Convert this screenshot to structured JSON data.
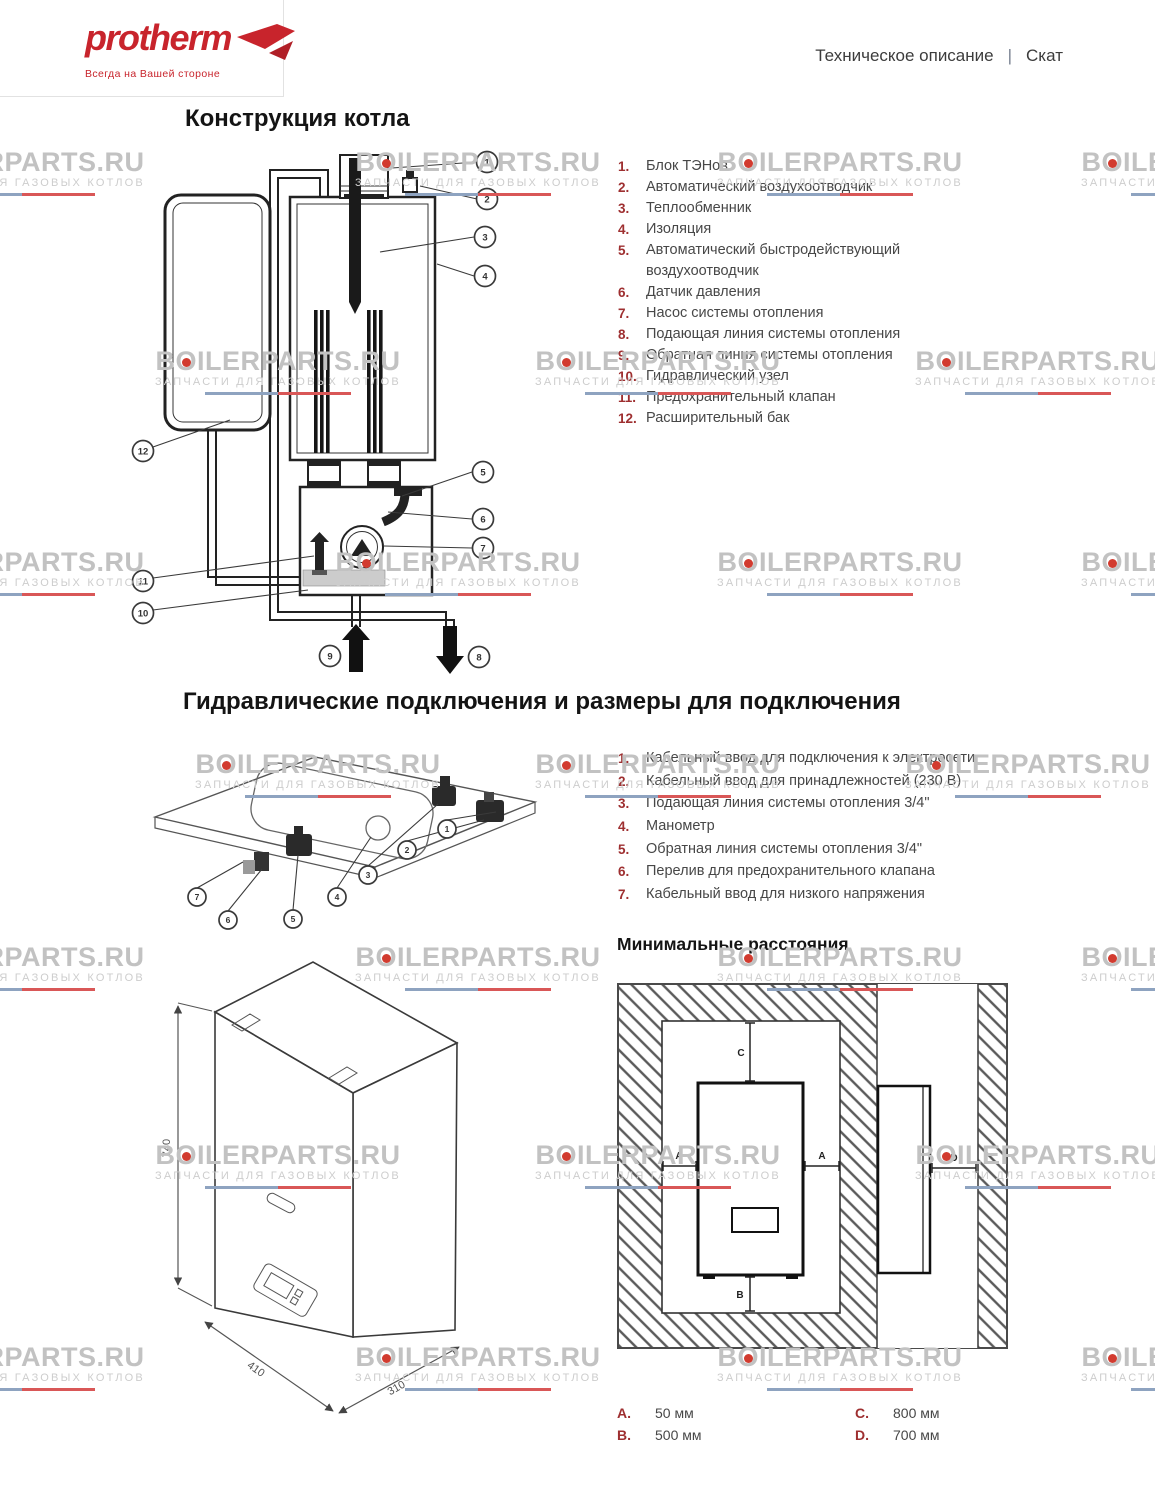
{
  "logo": {
    "brand": "protherm",
    "tagline": "Всегда на Вашей стороне"
  },
  "header": {
    "doc_type": "Техническое описание",
    "separator": "|",
    "model": "Скат"
  },
  "watermark": {
    "line1": "BOILERPARTS.RU",
    "line2": "ЗАПЧАСТИ ДЛЯ ГАЗОВЫХ КОТЛОВ"
  },
  "sections": {
    "construction": {
      "title": "Конструкция котла",
      "legend": [
        {
          "num": "1.",
          "label": "Блок ТЭНов"
        },
        {
          "num": "2.",
          "label": "Автоматический воздухоотводчик"
        },
        {
          "num": "3.",
          "label": "Теплообменник"
        },
        {
          "num": "4.",
          "label": "Изоляция"
        },
        {
          "num": "5.",
          "label": "Автоматический быстродействующий воздухоотводчик"
        },
        {
          "num": "6.",
          "label": "Датчик давления"
        },
        {
          "num": "7.",
          "label": "Насос системы отопления"
        },
        {
          "num": "8.",
          "label": "Подающая линия системы отопления"
        },
        {
          "num": "9.",
          "label": "Обратная линия системы отопления"
        },
        {
          "num": "10.",
          "label": "Гидравлический узел"
        },
        {
          "num": "11.",
          "label": "Предохранительный клапан"
        },
        {
          "num": "12.",
          "label": "Расширительный бак"
        }
      ],
      "callouts": [
        "1",
        "2",
        "3",
        "4",
        "5",
        "6",
        "7",
        "8",
        "9",
        "10",
        "11",
        "12"
      ]
    },
    "hydraulic": {
      "title": "Гидравлические подключения и размеры для подключения",
      "legend": [
        {
          "num": "1.",
          "label": "Кабельный ввод для подключения к электросети"
        },
        {
          "num": "2.",
          "label": "Кабельный ввод для принадлежностей (230 В)"
        },
        {
          "num": "3.",
          "label": "Подающая линия системы отопления 3/4\""
        },
        {
          "num": "4.",
          "label": "Манометр"
        },
        {
          "num": "5.",
          "label": "Обратная линия системы отопления 3/4\""
        },
        {
          "num": "6.",
          "label": "Перелив для предохранительного клапана"
        },
        {
          "num": "7.",
          "label": "Кабельный ввод для низкого напряжения"
        }
      ],
      "callouts": [
        "1",
        "2",
        "3",
        "4",
        "5",
        "6",
        "7"
      ]
    },
    "distances": {
      "title": "Минимальные расстояния",
      "diagram_labels": {
        "a": "A",
        "b": "B",
        "c": "C",
        "d": "D"
      },
      "values_left": [
        {
          "key": "A.",
          "value": "50 мм"
        },
        {
          "key": "B.",
          "value": "500 мм"
        }
      ],
      "values_right": [
        {
          "key": "C.",
          "value": "800 мм"
        },
        {
          "key": "D.",
          "value": "700 мм"
        }
      ]
    },
    "dimensions_drawing": {
      "height": "740",
      "width": "410",
      "depth": "310"
    }
  },
  "colors": {
    "brand_red": "#c8242c",
    "legend_number": "#9e2f30",
    "watermark_text": "#c3c3c3",
    "watermark_line_blue": "#8ea3c0",
    "watermark_line_red": "#d95757"
  }
}
